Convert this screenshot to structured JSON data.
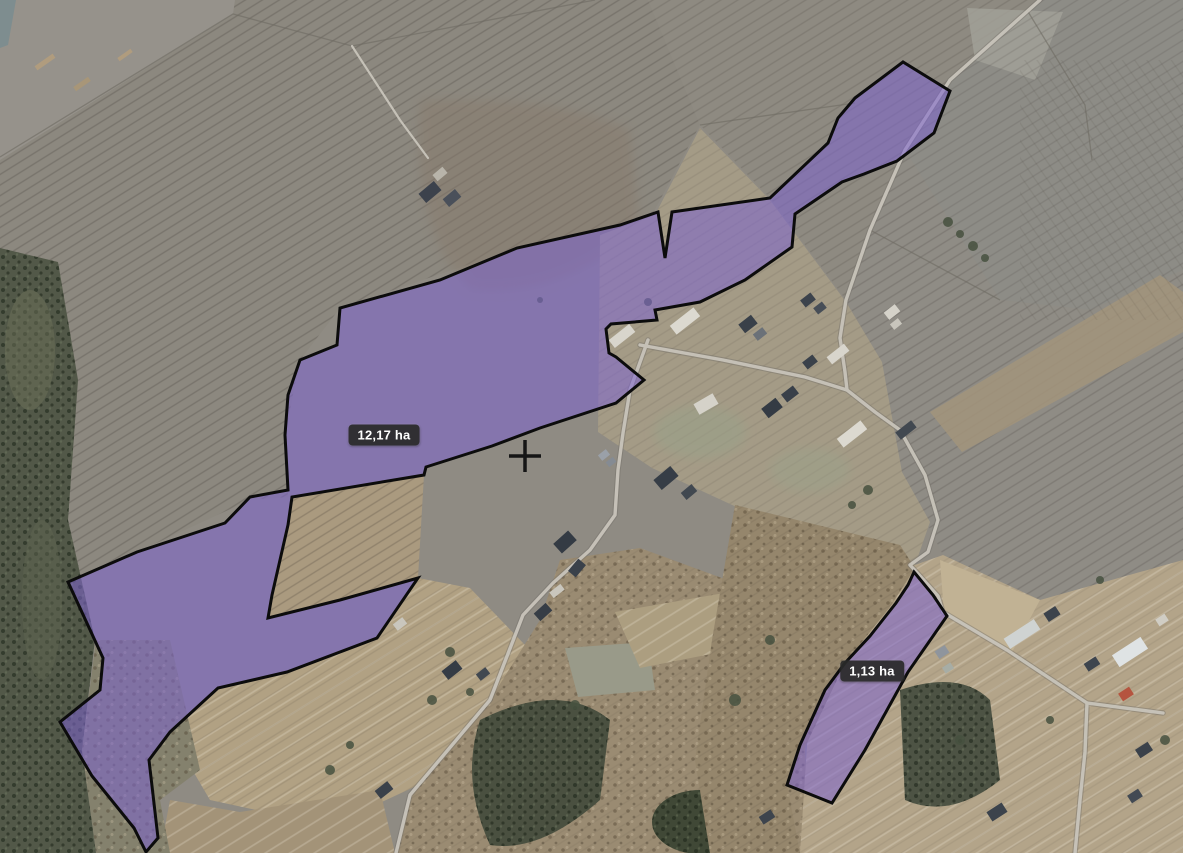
{
  "map": {
    "description": "aerial-imagery parcel map",
    "parcels": [
      {
        "id": "parcel-1",
        "area_label": "12,17 ha",
        "points": "855,98 903,62 950,91 937,125 934,133 897,161 864,174 842,182 795,214 792,247 745,280 700,302 655,310 657,320 611,324 606,329 609,353 616,357 644,380 616,403 540,428 492,446 426,467 424,475 292,497 288,525 272,595 268,618 340,600 418,578 377,638 287,672 218,688 170,732 149,760 158,838 146,852 134,828 92,776 60,722 100,690 103,658 68,582 137,552 225,523 250,497 288,490 285,435 288,395 300,360 337,345 340,308 440,280 517,248 620,225 658,212 665,258 672,212 770,198 828,143 838,118"
      },
      {
        "id": "parcel-2",
        "area_label": "1,13 ha",
        "points": "914,572 933,595 947,616 908,672 865,750 832,803 787,785 800,745 825,690 845,663 870,636 896,603 908,585"
      }
    ],
    "crosshair": {
      "transform": "translate(525,456)"
    },
    "colors": {
      "parcel_fill": "#7e64cf",
      "parcel_fill_opacity": "0.55",
      "parcel_outline": "#0c0c0c",
      "label_background": "#3a3a3a",
      "label_text": "#ffffff",
      "crosshair": "#151515"
    }
  }
}
